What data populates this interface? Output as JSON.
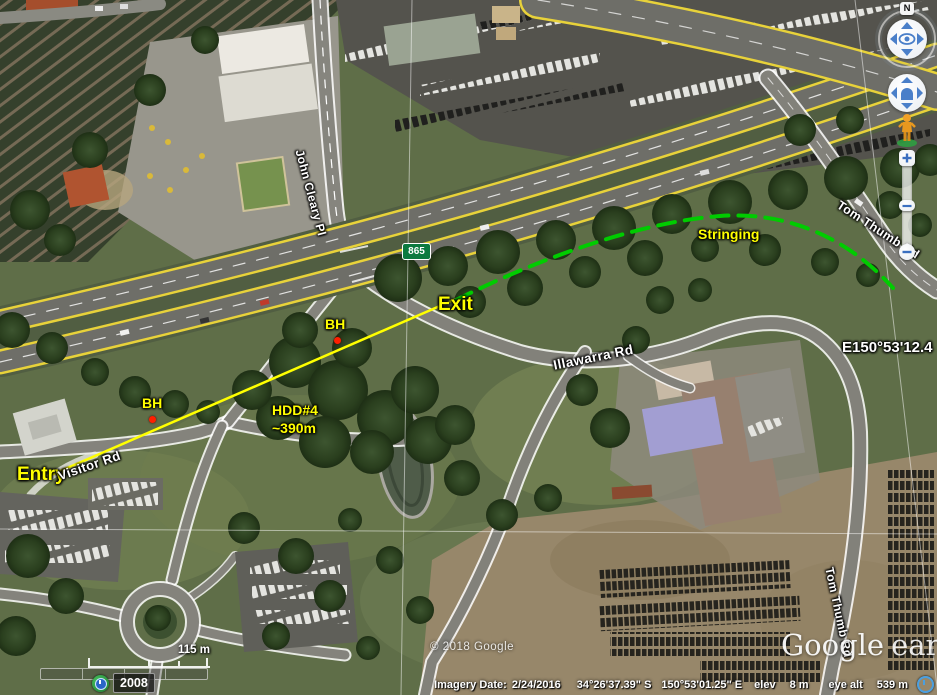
{
  "annotations": {
    "entry_label": "Entry",
    "exit_label": "Exit",
    "borehole1_label": "BH",
    "borehole2_label": "BH",
    "hdd_name": "HDD#4",
    "hdd_length": "~390m",
    "stringing_label": "Stringing",
    "line_color": "#ffff00",
    "stringing_color": "#00cc00",
    "borehole_color": "#ff1f00"
  },
  "road_labels": {
    "john_cleary_pl": "John Cleary Pl",
    "visitor_rd": "Visitor Rd",
    "illawarra_rd": "Illawarra Rd",
    "tom_thumb_rd": "Tom Thumb Rd",
    "tom_thumb_rd_south": "Tom Thumb Rd",
    "route_shield": "865"
  },
  "graticule": {
    "longitude_label": "E150°53'12.4"
  },
  "navigation": {
    "north_label": "N"
  },
  "scale": {
    "label": "115 m"
  },
  "time_slider": {
    "year": "2008"
  },
  "watermarks": {
    "copyright": "© 2018 Google",
    "logo_primary": "Google",
    "logo_secondary": "earth"
  },
  "status_bar": {
    "imagery_date_label": "Imagery Date:",
    "imagery_date_value": "2/24/2016",
    "latitude": "34°26'37.39\" S",
    "longitude": "150°53'01.25\" E",
    "elevation_label": "elev",
    "elevation_value": "8 m",
    "eye_altitude_label": "eye alt",
    "eye_altitude_value": "539 m"
  }
}
